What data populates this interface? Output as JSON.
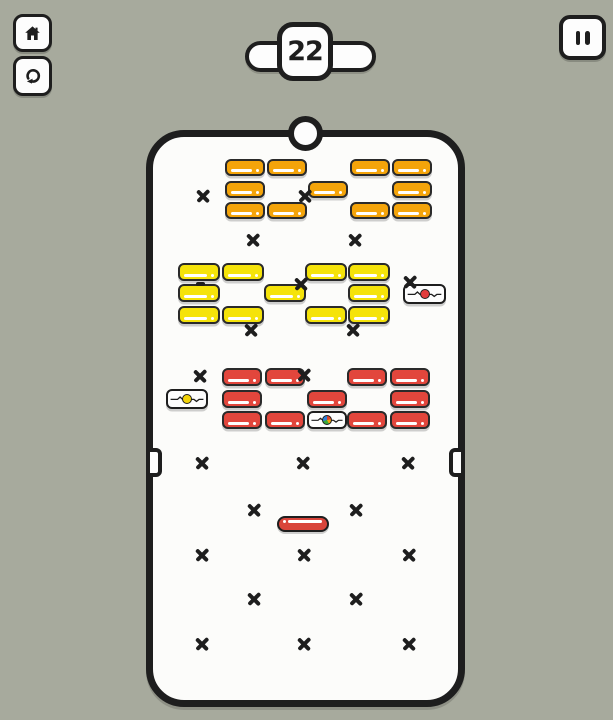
{
  "hud": {
    "level": "22",
    "home_icon": "home-icon",
    "restart_icon": "restart-icon",
    "pause_icon": "pause-icon"
  },
  "colors": {
    "background": "#a7aa9d",
    "board": "#fcfcfa",
    "line": "#1e1e1e",
    "orange": "#f4a40a",
    "yellow": "#f5e30a",
    "red": "#e2463c",
    "paddle": "#d9453b",
    "dot_red": "#e23c3c",
    "dot_yellow": "#f2d309"
  },
  "board": {
    "bricks": [
      {
        "x": 225,
        "y": 159,
        "w": 40,
        "h": 17,
        "color": "orange"
      },
      {
        "x": 267,
        "y": 159,
        "w": 40,
        "h": 17,
        "color": "orange"
      },
      {
        "x": 350,
        "y": 159,
        "w": 40,
        "h": 17,
        "color": "orange"
      },
      {
        "x": 392,
        "y": 159,
        "w": 40,
        "h": 17,
        "color": "orange"
      },
      {
        "x": 225,
        "y": 181,
        "w": 40,
        "h": 17,
        "color": "orange"
      },
      {
        "x": 308,
        "y": 181,
        "w": 40,
        "h": 17,
        "color": "orange"
      },
      {
        "x": 392,
        "y": 181,
        "w": 40,
        "h": 17,
        "color": "orange"
      },
      {
        "x": 225,
        "y": 202,
        "w": 40,
        "h": 17,
        "color": "orange"
      },
      {
        "x": 267,
        "y": 202,
        "w": 40,
        "h": 17,
        "color": "orange"
      },
      {
        "x": 350,
        "y": 202,
        "w": 40,
        "h": 17,
        "color": "orange"
      },
      {
        "x": 392,
        "y": 202,
        "w": 40,
        "h": 17,
        "color": "orange"
      },
      {
        "x": 178,
        "y": 263,
        "w": 42,
        "h": 18,
        "color": "yellow"
      },
      {
        "x": 222,
        "y": 263,
        "w": 42,
        "h": 18,
        "color": "yellow"
      },
      {
        "x": 305,
        "y": 263,
        "w": 42,
        "h": 18,
        "color": "yellow"
      },
      {
        "x": 348,
        "y": 263,
        "w": 42,
        "h": 18,
        "color": "yellow"
      },
      {
        "x": 178,
        "y": 284,
        "w": 42,
        "h": 18,
        "color": "yellow"
      },
      {
        "x": 264,
        "y": 284,
        "w": 42,
        "h": 18,
        "color": "yellow"
      },
      {
        "x": 348,
        "y": 284,
        "w": 42,
        "h": 18,
        "color": "yellow"
      },
      {
        "x": 178,
        "y": 306,
        "w": 42,
        "h": 18,
        "color": "yellow"
      },
      {
        "x": 222,
        "y": 306,
        "w": 42,
        "h": 18,
        "color": "yellow"
      },
      {
        "x": 305,
        "y": 306,
        "w": 42,
        "h": 18,
        "color": "yellow"
      },
      {
        "x": 348,
        "y": 306,
        "w": 42,
        "h": 18,
        "color": "yellow"
      },
      {
        "x": 222,
        "y": 368,
        "w": 40,
        "h": 18,
        "color": "red"
      },
      {
        "x": 265,
        "y": 368,
        "w": 40,
        "h": 18,
        "color": "red"
      },
      {
        "x": 347,
        "y": 368,
        "w": 40,
        "h": 18,
        "color": "red"
      },
      {
        "x": 390,
        "y": 368,
        "w": 40,
        "h": 18,
        "color": "red"
      },
      {
        "x": 222,
        "y": 390,
        "w": 40,
        "h": 18,
        "color": "red"
      },
      {
        "x": 307,
        "y": 390,
        "w": 40,
        "h": 18,
        "color": "red"
      },
      {
        "x": 390,
        "y": 390,
        "w": 40,
        "h": 18,
        "color": "red"
      },
      {
        "x": 222,
        "y": 411,
        "w": 40,
        "h": 18,
        "color": "red"
      },
      {
        "x": 265,
        "y": 411,
        "w": 40,
        "h": 18,
        "color": "red"
      },
      {
        "x": 347,
        "y": 411,
        "w": 40,
        "h": 18,
        "color": "red"
      },
      {
        "x": 390,
        "y": 411,
        "w": 40,
        "h": 18,
        "color": "red"
      }
    ],
    "special_bricks": [
      {
        "x": 403,
        "y": 284,
        "w": 43,
        "h": 20,
        "dot": "red"
      },
      {
        "x": 166,
        "y": 389,
        "w": 42,
        "h": 20,
        "dot": "yellow"
      },
      {
        "x": 307,
        "y": 411,
        "w": 40,
        "h": 18,
        "dot": "multi"
      }
    ],
    "x_marks": [
      [
        203,
        196
      ],
      [
        305,
        196
      ],
      [
        253,
        240
      ],
      [
        355,
        240
      ],
      [
        301,
        284
      ],
      [
        410,
        282
      ],
      [
        251,
        330
      ],
      [
        353,
        330
      ],
      [
        200,
        376
      ],
      [
        304,
        375
      ],
      [
        202,
        463
      ],
      [
        303,
        463
      ],
      [
        408,
        463
      ],
      [
        254,
        510
      ],
      [
        356,
        510
      ],
      [
        202,
        555
      ],
      [
        304,
        555
      ],
      [
        409,
        555
      ],
      [
        254,
        599
      ],
      [
        356,
        599
      ],
      [
        202,
        644
      ],
      [
        304,
        644
      ],
      [
        409,
        644
      ]
    ],
    "dash_marks": [
      [
        200,
        284
      ]
    ],
    "notches": [
      {
        "side": "left",
        "x": 146,
        "y": 448
      },
      {
        "side": "right",
        "x": 449,
        "y": 448
      }
    ],
    "ball": {
      "cx": 305,
      "cy": 133
    },
    "paddle": {
      "x": 277,
      "y": 516,
      "w": 52,
      "h": 16
    }
  }
}
